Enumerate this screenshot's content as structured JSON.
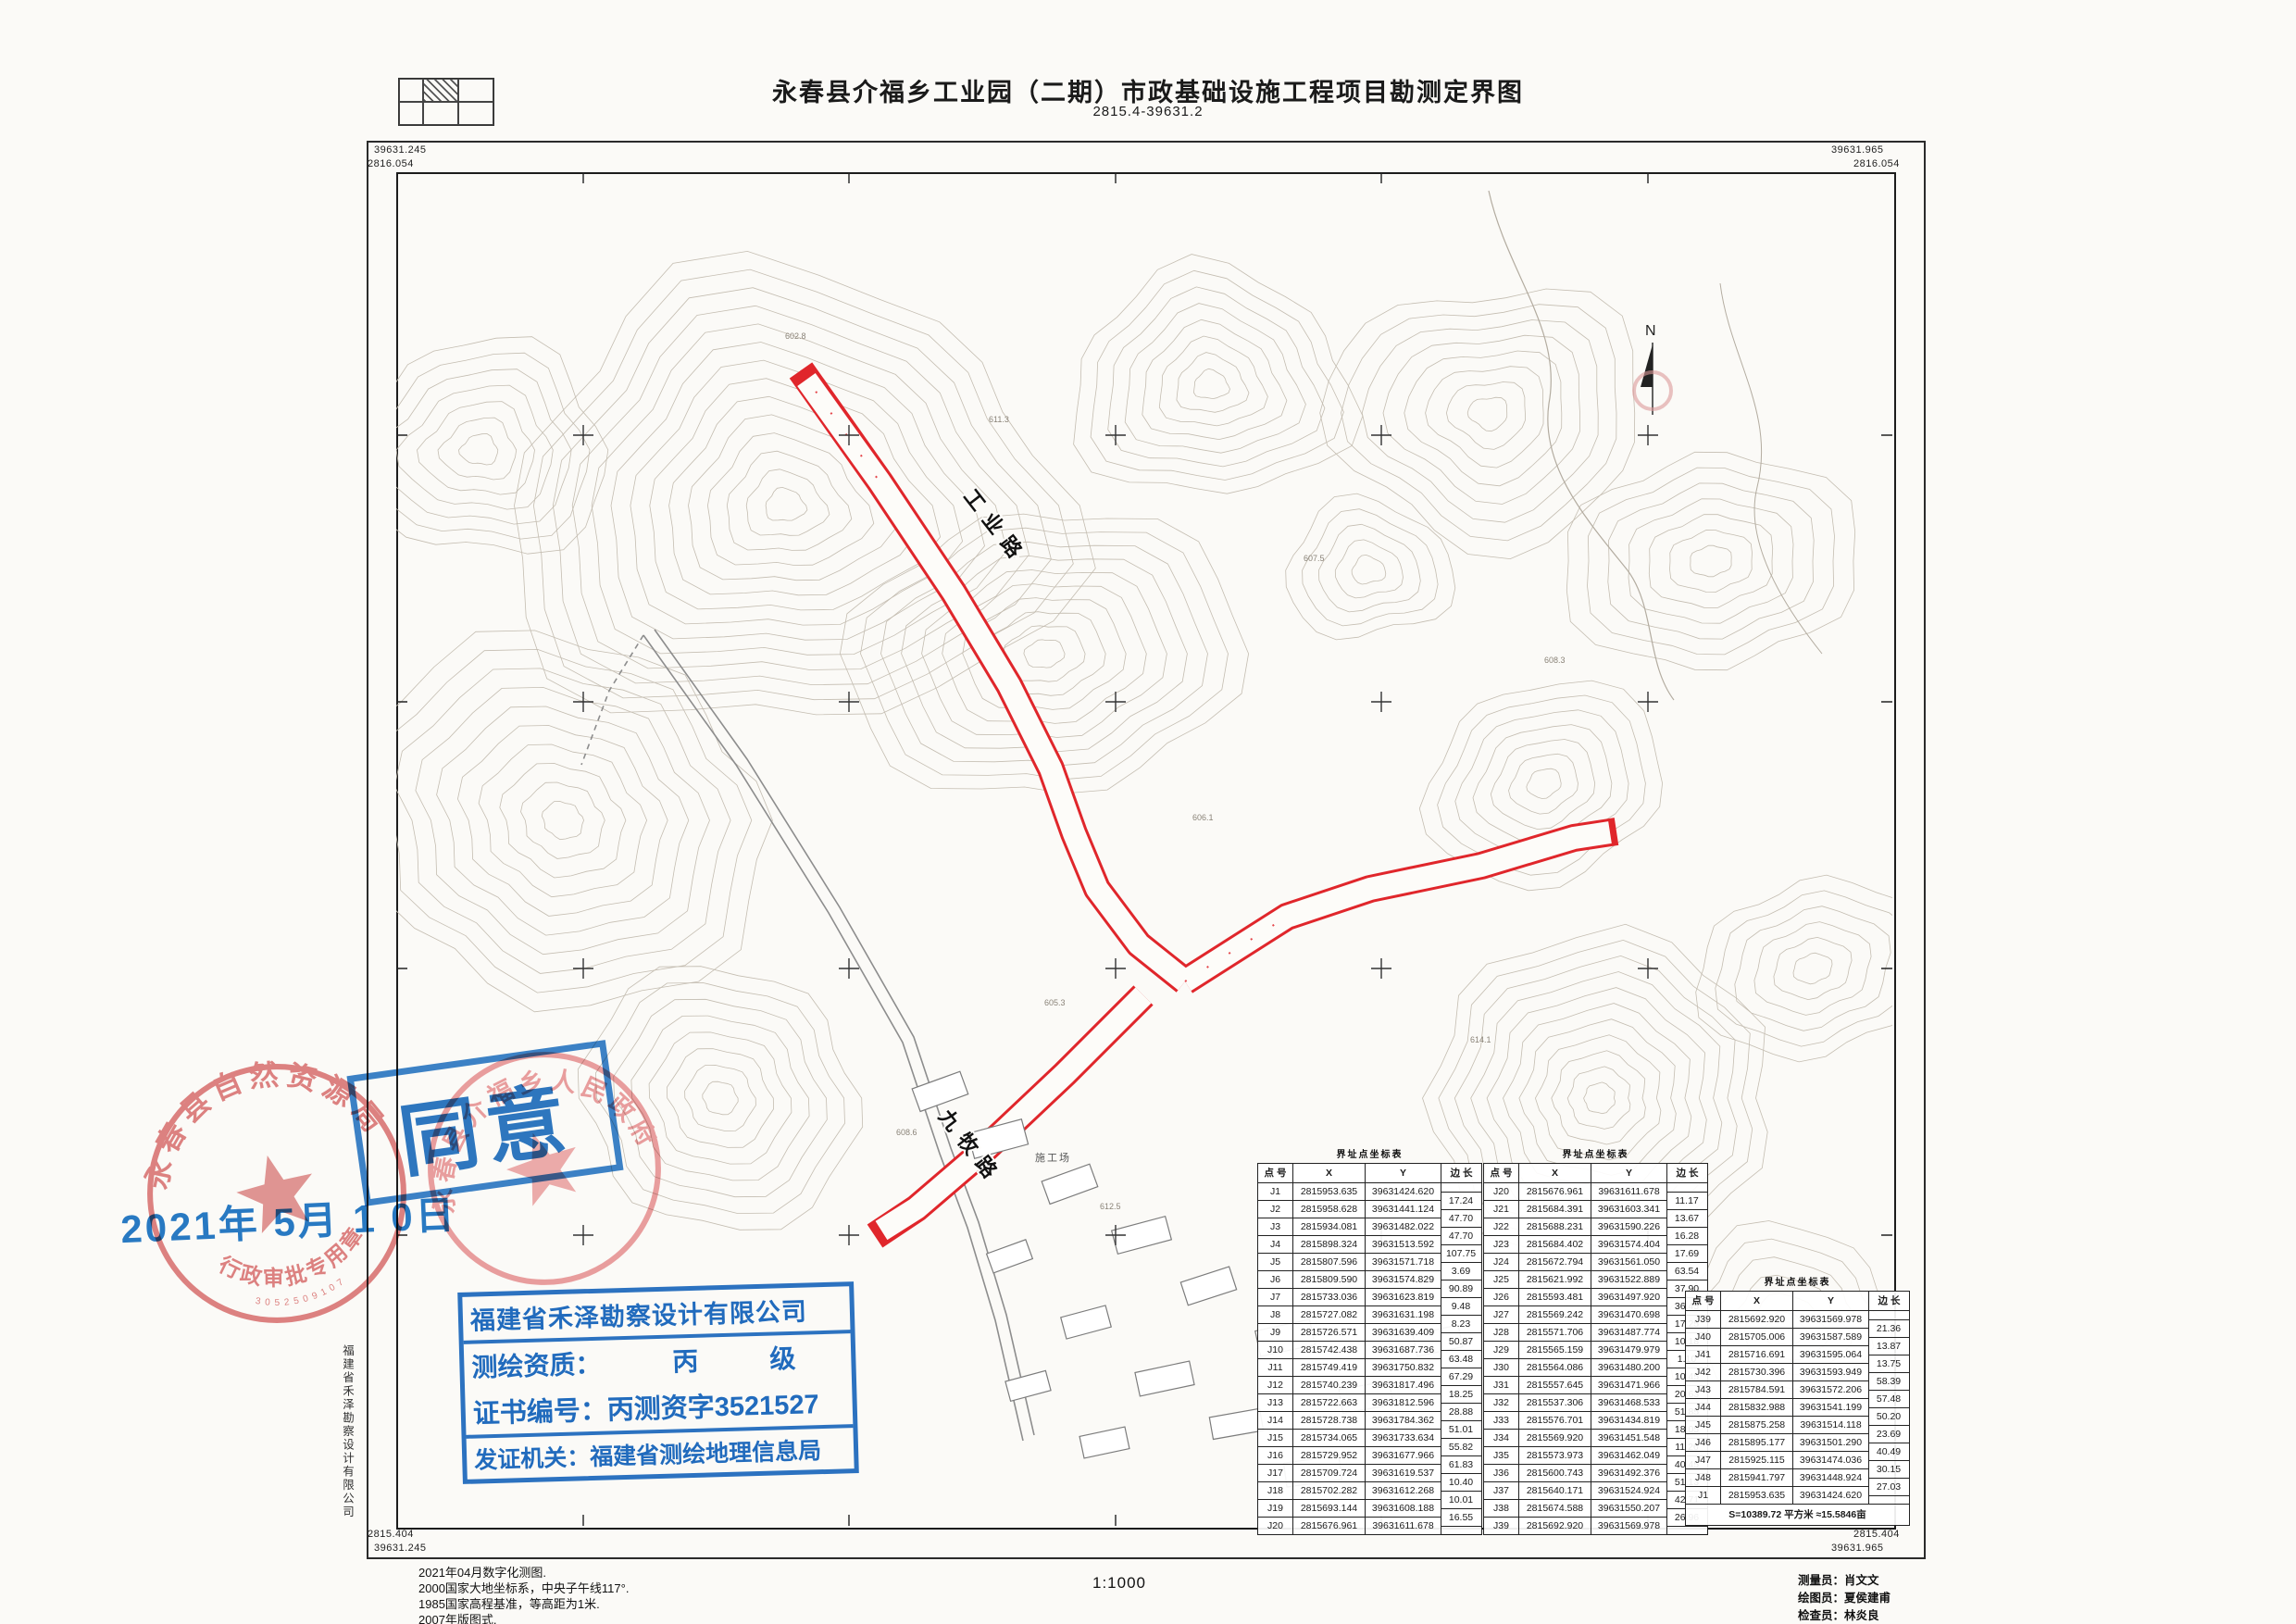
{
  "title": {
    "main": "永春县介福乡工业园（二期）市政基础设施工程项目勘测定界图",
    "sub": "2815.4-39631.2"
  },
  "frame": {
    "top_left_y": "39631.245",
    "top_left_x": "2816.054",
    "top_right_y": "39631.965",
    "top_right_x": "2816.054",
    "bottom_left_x": "2815.404",
    "bottom_left_y": "39631.245",
    "bottom_right_x": "2815.404",
    "bottom_right_y": "39631.965"
  },
  "map": {
    "north_label": "N",
    "road_labels": [
      {
        "text": "工业路"
      },
      {
        "text": "九牧路"
      }
    ],
    "site_label": "施工场",
    "spot_heights": [
      "611.3",
      "602.8",
      "607.5",
      "608.3",
      "606.1",
      "605.3",
      "608.6",
      "612.5",
      "614.1",
      "609.2"
    ],
    "boundary_color": "#e0262b"
  },
  "stamps": {
    "seal1": {
      "ring": "永春县自然资源局",
      "banner": "行政审批专用章",
      "serial": "3052509107"
    },
    "seal2": {
      "ring": "永春县介福乡人民政府"
    },
    "approval": {
      "text": "同意",
      "date": "2021年 5月 1 0日"
    },
    "license": {
      "line1": "福建省禾泽勘察设计有限公司",
      "q_label": "测绘资质：",
      "q_v1": "丙",
      "q_v2": "级",
      "line3": "证书编号：丙测资字3521527",
      "line4": "发证机关：福建省测绘地理信息局"
    }
  },
  "side_text": "福建省禾泽勘察设计有限公司",
  "tables": {
    "title": "界址点坐标表",
    "headers": [
      "点 号",
      "X",
      "Y",
      "边 长"
    ],
    "t1": {
      "points": [
        [
          "J1",
          "2815953.635",
          "39631424.620"
        ],
        [
          "J2",
          "2815958.628",
          "39631441.124"
        ],
        [
          "J3",
          "2815934.081",
          "39631482.022"
        ],
        [
          "J4",
          "2815898.324",
          "39631513.592"
        ],
        [
          "J5",
          "2815807.596",
          "39631571.718"
        ],
        [
          "J6",
          "2815809.590",
          "39631574.829"
        ],
        [
          "J7",
          "2815733.036",
          "39631623.819"
        ],
        [
          "J8",
          "2815727.082",
          "39631631.198"
        ],
        [
          "J9",
          "2815726.571",
          "39631639.409"
        ],
        [
          "J10",
          "2815742.438",
          "39631687.736"
        ],
        [
          "J11",
          "2815749.419",
          "39631750.832"
        ],
        [
          "J12",
          "2815740.239",
          "39631817.496"
        ],
        [
          "J13",
          "2815722.663",
          "39631812.596"
        ],
        [
          "J14",
          "2815728.738",
          "39631784.362"
        ],
        [
          "J15",
          "2815734.065",
          "39631733.634"
        ],
        [
          "J16",
          "2815729.952",
          "39631677.966"
        ],
        [
          "J17",
          "2815709.724",
          "39631619.537"
        ],
        [
          "J18",
          "2815702.282",
          "39631612.268"
        ],
        [
          "J19",
          "2815693.144",
          "39631608.188"
        ],
        [
          "J20",
          "2815676.961",
          "39631611.678"
        ]
      ],
      "edges": [
        "17.24",
        "47.70",
        "47.70",
        "107.75",
        "3.69",
        "90.89",
        "9.48",
        "8.23",
        "50.87",
        "63.48",
        "67.29",
        "18.25",
        "28.88",
        "51.01",
        "55.82",
        "61.83",
        "10.40",
        "10.01",
        "16.55"
      ]
    },
    "t2": {
      "points": [
        [
          "J20",
          "2815676.961",
          "39631611.678"
        ],
        [
          "J21",
          "2815684.391",
          "39631603.341"
        ],
        [
          "J22",
          "2815688.231",
          "39631590.226"
        ],
        [
          "J23",
          "2815684.402",
          "39631574.404"
        ],
        [
          "J24",
          "2815672.794",
          "39631561.050"
        ],
        [
          "J25",
          "2815621.992",
          "39631522.889"
        ],
        [
          "J26",
          "2815593.481",
          "39631497.920"
        ],
        [
          "J27",
          "2815569.242",
          "39631470.698"
        ],
        [
          "J28",
          "2815571.706",
          "39631487.774"
        ],
        [
          "J29",
          "2815565.159",
          "39631479.979"
        ],
        [
          "J30",
          "2815564.086",
          "39631480.200"
        ],
        [
          "J31",
          "2815557.645",
          "39631471.966"
        ],
        [
          "J32",
          "2815537.306",
          "39631468.533"
        ],
        [
          "J33",
          "2815576.701",
          "39631434.819"
        ],
        [
          "J34",
          "2815569.920",
          "39631451.548"
        ],
        [
          "J35",
          "2815573.973",
          "39631462.049"
        ],
        [
          "J36",
          "2815600.743",
          "39631492.376"
        ],
        [
          "J37",
          "2815640.171",
          "39631524.924"
        ],
        [
          "J38",
          "2815674.588",
          "39631550.207"
        ],
        [
          "J39",
          "2815692.920",
          "39631569.978"
        ]
      ],
      "edges": [
        "11.17",
        "13.67",
        "16.28",
        "17.69",
        "63.54",
        "37.90",
        "36.45",
        "17.25",
        "10.18",
        "1.10",
        "10.45",
        "20.63",
        "51.85",
        "18.05",
        "11.26",
        "40.45",
        "51.13",
        "42.71",
        "26.96"
      ]
    },
    "t3": {
      "points": [
        [
          "J39",
          "2815692.920",
          "39631569.978"
        ],
        [
          "J40",
          "2815705.006",
          "39631587.589"
        ],
        [
          "J41",
          "2815716.691",
          "39631595.064"
        ],
        [
          "J42",
          "2815730.396",
          "39631593.949"
        ],
        [
          "J43",
          "2815784.591",
          "39631572.206"
        ],
        [
          "J44",
          "2815832.988",
          "39631541.199"
        ],
        [
          "J45",
          "2815875.258",
          "39631514.118"
        ],
        [
          "J46",
          "2815895.177",
          "39631501.290"
        ],
        [
          "J47",
          "2815925.115",
          "39631474.036"
        ],
        [
          "J48",
          "2815941.797",
          "39631448.924"
        ],
        [
          "J1",
          "2815953.635",
          "39631424.620"
        ]
      ],
      "edges": [
        "21.36",
        "13.87",
        "13.75",
        "58.39",
        "57.48",
        "50.20",
        "23.69",
        "40.49",
        "30.15",
        "27.03"
      ],
      "summary": "S=10389.72 平方米 ≈15.5846亩"
    }
  },
  "notes": [
    "2021年04月数字化测图.",
    "2000国家大地坐标系，中央子午线117°.",
    "1985国家高程基准，等高距为1米.",
    "2007年版图式."
  ],
  "scale": "1:1000",
  "credits": [
    "测量员：肖文文",
    "绘图员：夏侯建甫",
    "检查员：林炎良"
  ]
}
